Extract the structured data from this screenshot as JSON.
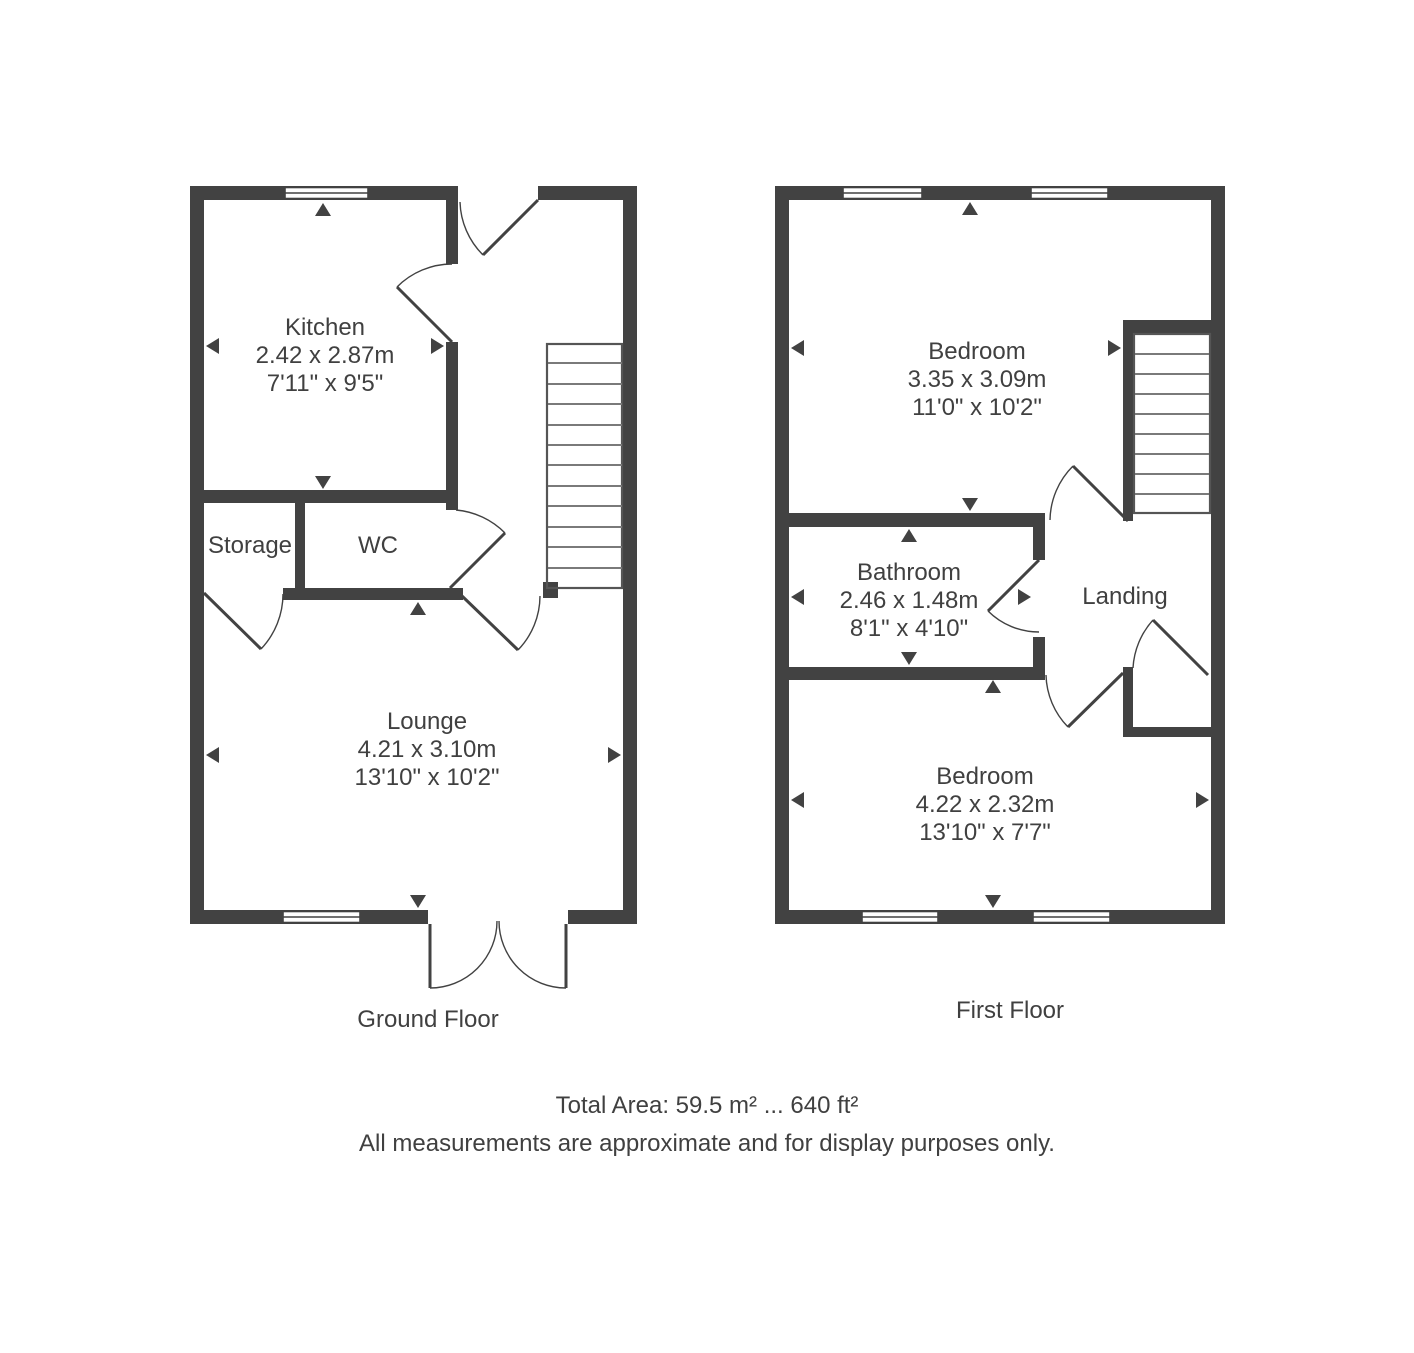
{
  "colors": {
    "wall": "#424242",
    "text": "#404040",
    "stair_outline": "#555555",
    "stair_tread": "#7a7a7a"
  },
  "ground": {
    "label": "Ground Floor",
    "kitchen": {
      "name": "Kitchen",
      "metric": "2.42 x 2.87m",
      "imperial": "7'11\" x 9'5\""
    },
    "storage": {
      "name": "Storage"
    },
    "wc": {
      "name": "WC"
    },
    "lounge": {
      "name": "Lounge",
      "metric": "4.21 x 3.10m",
      "imperial": "13'10\" x 10'2\""
    }
  },
  "first": {
    "label": "First Floor",
    "bedroom1": {
      "name": "Bedroom",
      "metric": "3.35 x 3.09m",
      "imperial": "11'0\" x 10'2\""
    },
    "bathroom": {
      "name": "Bathroom",
      "metric": "2.46 x 1.48m",
      "imperial": "8'1\" x 4'10\""
    },
    "landing": {
      "name": "Landing"
    },
    "bedroom2": {
      "name": "Bedroom",
      "metric": "4.22 x 2.32m",
      "imperial": "13'10\" x 7'7\""
    }
  },
  "footer": {
    "total_area": "Total Area: 59.5 m² ... 640 ft²",
    "disclaimer": "All measurements are approximate and for display purposes only."
  }
}
